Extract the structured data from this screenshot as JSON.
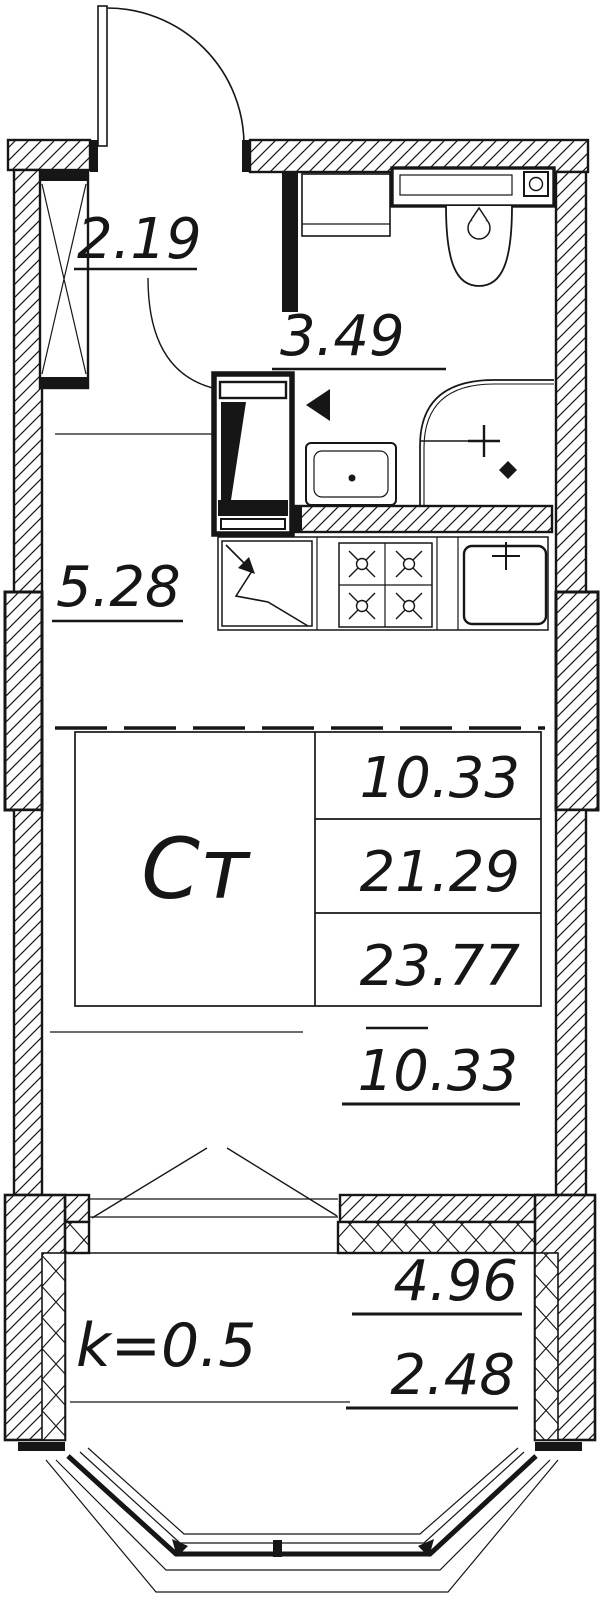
{
  "rooms": {
    "hallway": {
      "area": "2.19"
    },
    "bathroom": {
      "area": "3.49"
    },
    "kitchen": {
      "area": "5.28"
    },
    "living": {
      "type_label": "Ст",
      "zone_area": "10.33",
      "living_area": "21.29",
      "total_area": "23.77",
      "zone_area_bottom": "10.33"
    },
    "balcony": {
      "coefficient": "k=0.5",
      "area_full": "4.96",
      "area_reduced": "2.48"
    }
  },
  "colors": {
    "line": "#161616",
    "background": "#ffffff"
  }
}
